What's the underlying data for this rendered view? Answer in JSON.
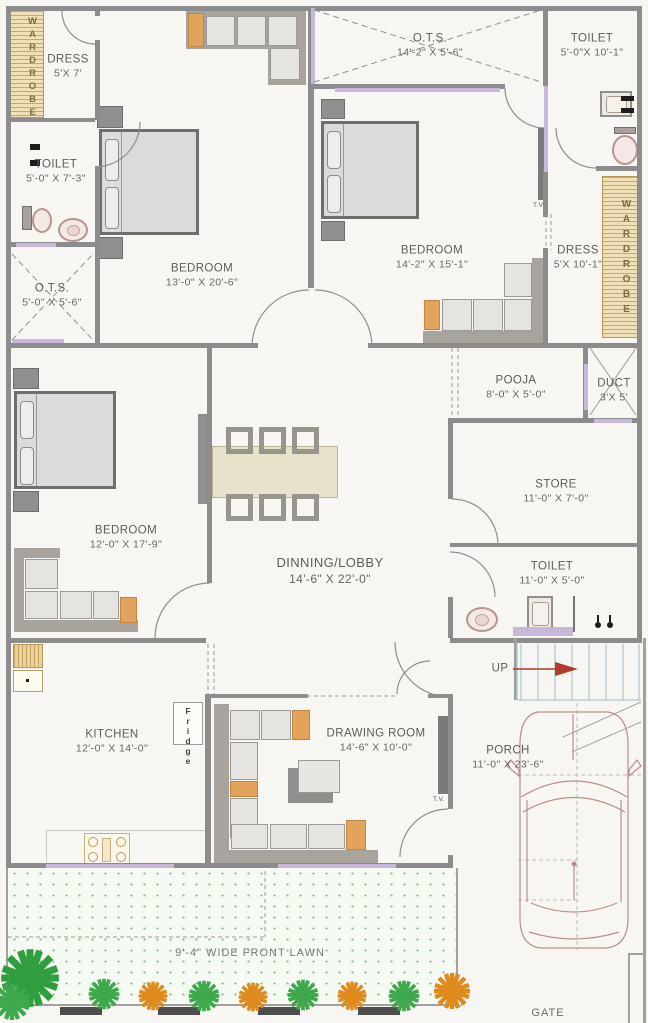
{
  "rooms": {
    "wardrobeLeft": {
      "label": "WARDROBE"
    },
    "dressLeft": {
      "label": "DRESS",
      "dims": "5'X 7'"
    },
    "toiletLeft": {
      "label": "TOILET",
      "dims": "5'-0\" X 7'-3\""
    },
    "otsLeft": {
      "label": "O.T.S.",
      "dims": "5'-0\" X 5'-6\""
    },
    "bedroom1": {
      "label": "BEDROOM",
      "dims": "13'-0\" X 20'-6\""
    },
    "otsTop": {
      "label": "O.T.S.",
      "dims": "14'-2\" X 5'-6\""
    },
    "bedroom2": {
      "label": "BEDROOM",
      "dims": "14'-2\" X 15'-1\""
    },
    "toiletRight": {
      "label": "TOILET",
      "dims": "5'-0\"X 10'-1\""
    },
    "dressRight": {
      "label": "DRESS",
      "dims": "5'X 10'-1\""
    },
    "wardrobeRight": {
      "label": "WARDROBE"
    },
    "bedroom3": {
      "label": "BEDROOM",
      "dims": "12'-0\" X 17'-9\""
    },
    "dining": {
      "label": "DINNING/LOBBY",
      "dims": "14'-6\" X 22'-0\""
    },
    "pooja": {
      "label": "POOJA",
      "dims": "8'-0\" X 5'-0\""
    },
    "duct": {
      "label": "DUCT",
      "dims": "3'X 5'"
    },
    "store": {
      "label": "STORE",
      "dims": "11'-0\" X 7'-0\""
    },
    "toiletCommon": {
      "label": "TOILET",
      "dims": "11'-0\" X 5'-0\""
    },
    "kitchen": {
      "label": "KITCHEN",
      "dims": "12'-0\" X 14'-0\""
    },
    "drawing": {
      "label": "DRAWING ROOM",
      "dims": "14'-6\" X 10'-0\""
    },
    "porch": {
      "label": "PORCH",
      "dims": "11'-0\" X 23'-6\""
    },
    "lawn": {
      "label": "9'-4\" WIDE FRONT LAWN"
    },
    "gate": {
      "label": "GATE"
    }
  },
  "annotations": {
    "up": "UP",
    "fridge": "Fridge",
    "tv": "T.V."
  },
  "colors": {
    "wall": "#8c8c8c",
    "window": "#c9b7da",
    "wardrobe_hatch": "#e9d8ae",
    "sofa_accent": "#e2a35c",
    "stairs": "#a9cbce",
    "up_arrow": "#b13a2a",
    "car_outline": "#bb8f88",
    "lawn_dots": "#8abc8a",
    "plant_green": "#3da84c",
    "plant_orange": "#de8a1c"
  }
}
